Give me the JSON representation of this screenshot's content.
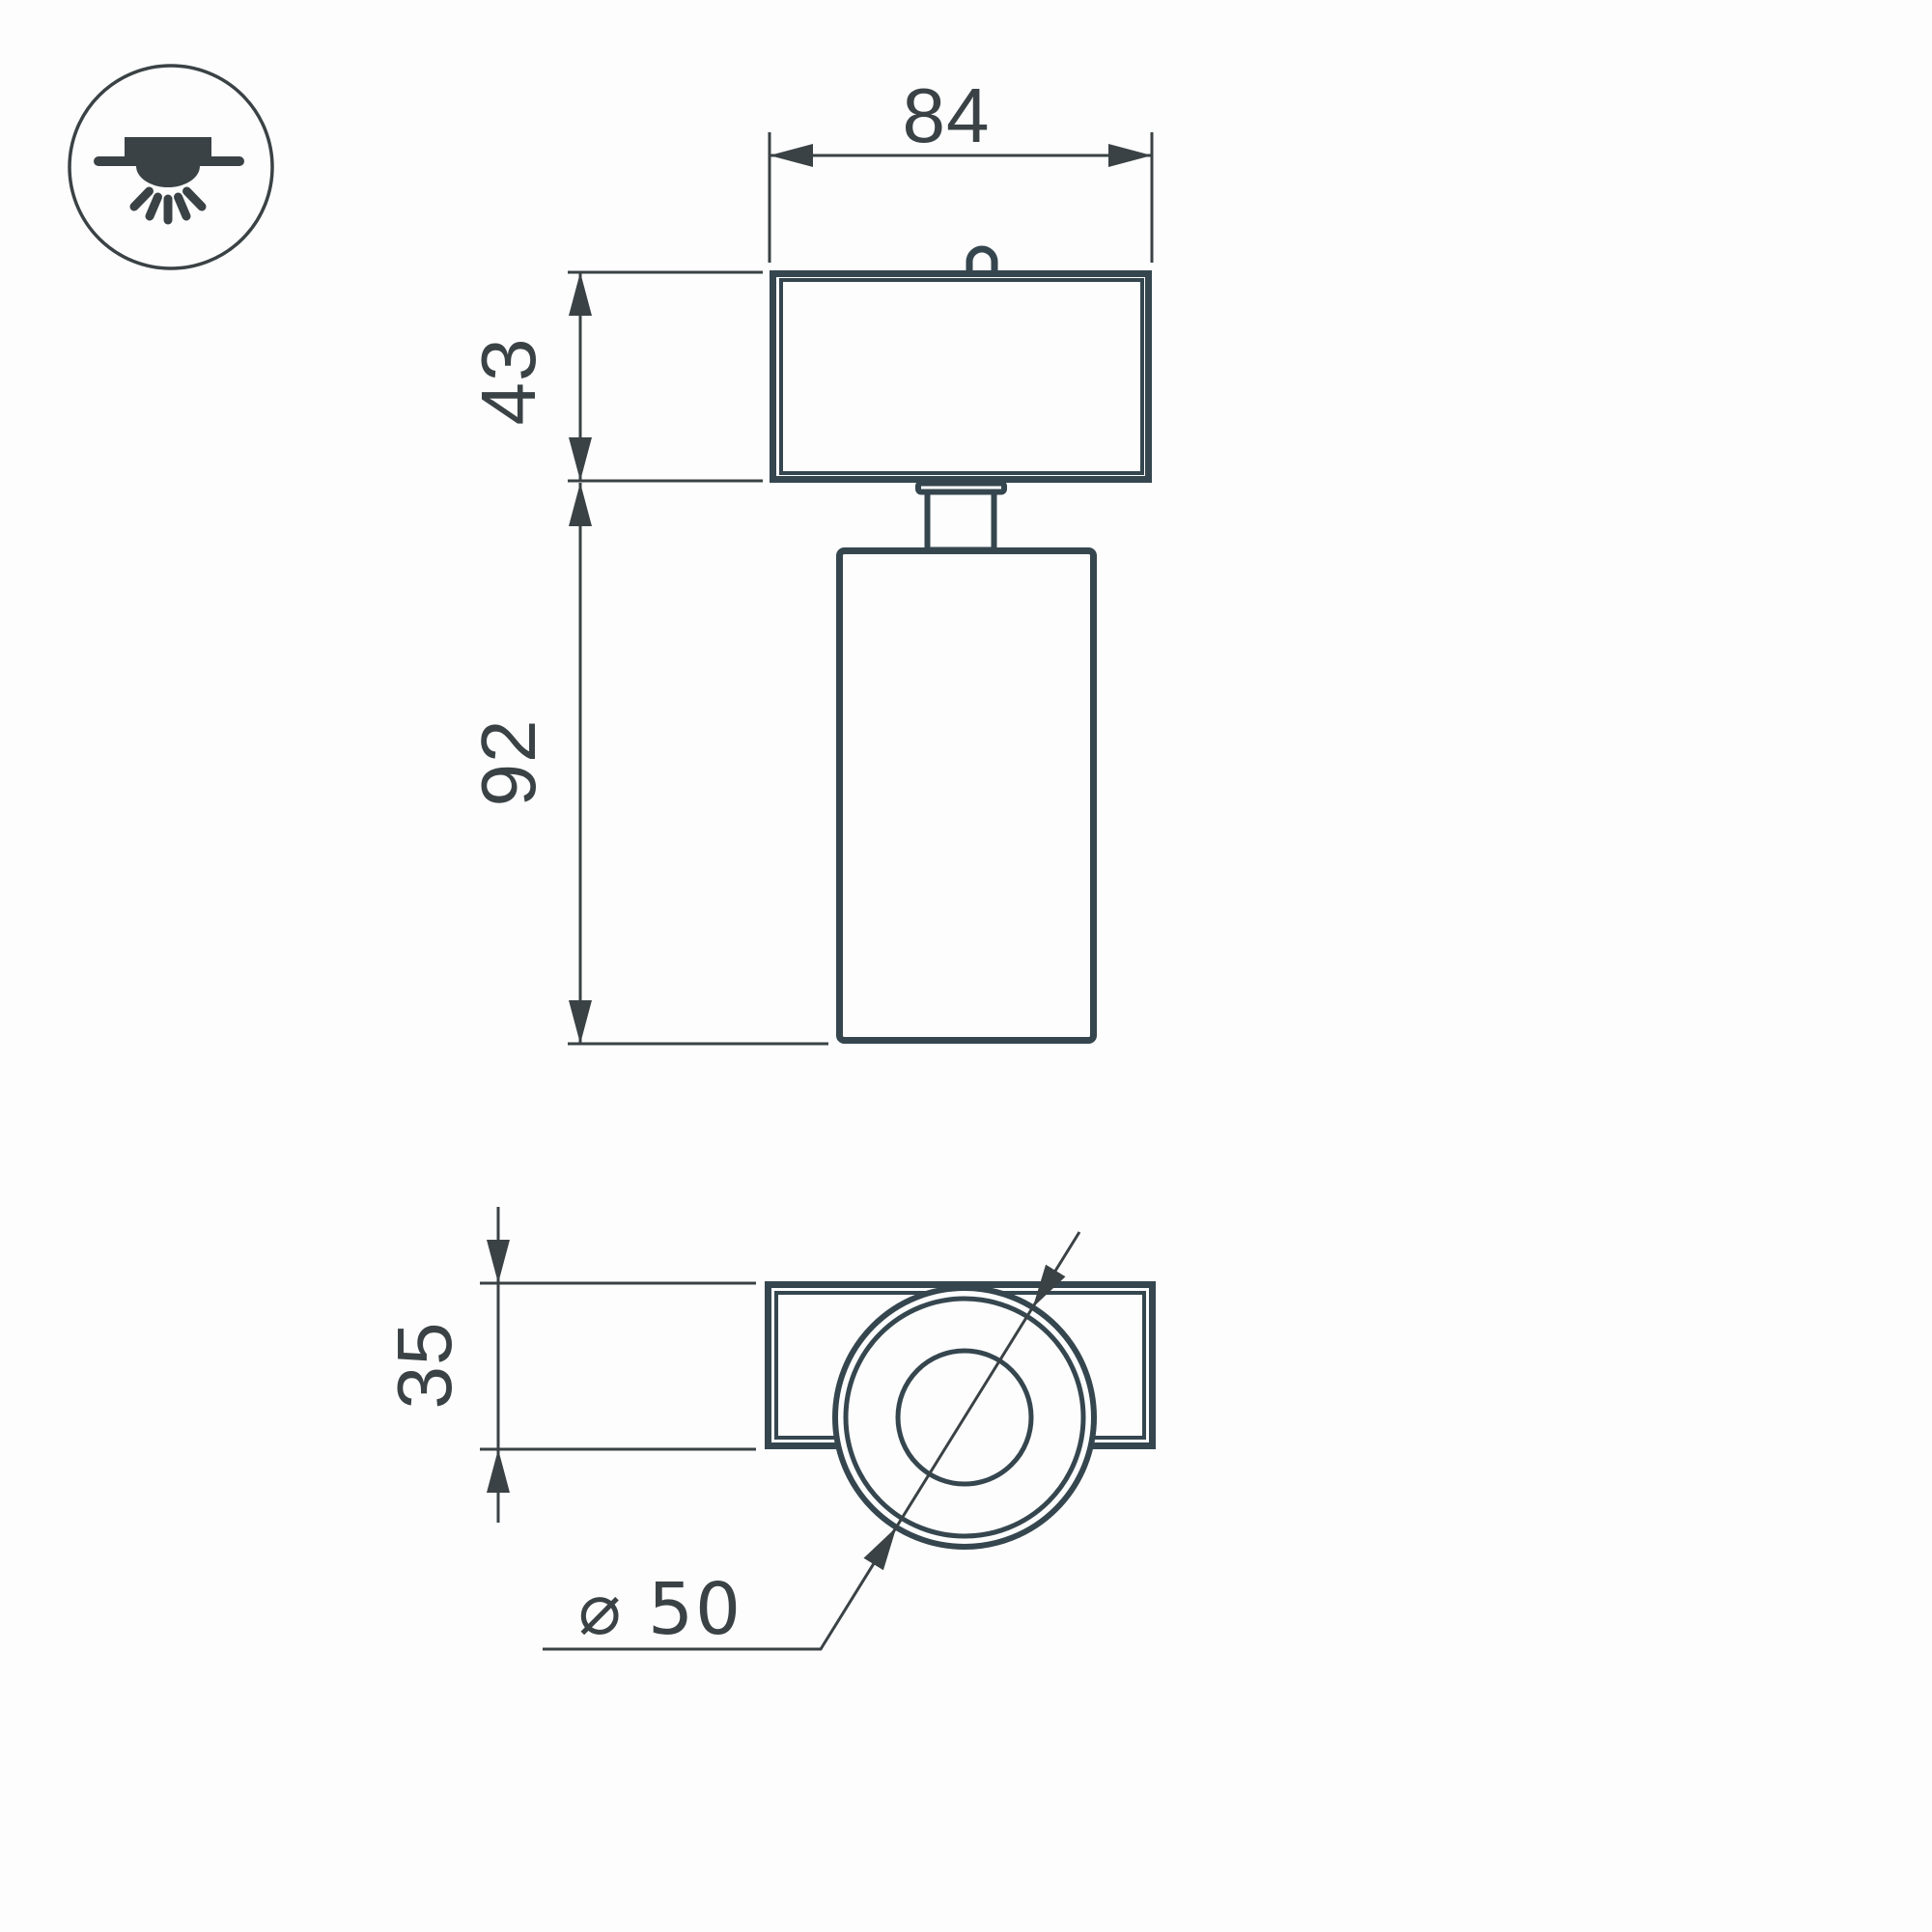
{
  "colors": {
    "ink": "#3a4245",
    "line": "#35464f",
    "background": "#fdfdfd"
  },
  "icon": {
    "name": "recessed-ceiling-downlight-icon"
  },
  "front_view": {
    "width": "84",
    "canopy_height": "43",
    "body_height": "92"
  },
  "bottom_view": {
    "depth": "35",
    "diameter": "⌀ 50"
  }
}
